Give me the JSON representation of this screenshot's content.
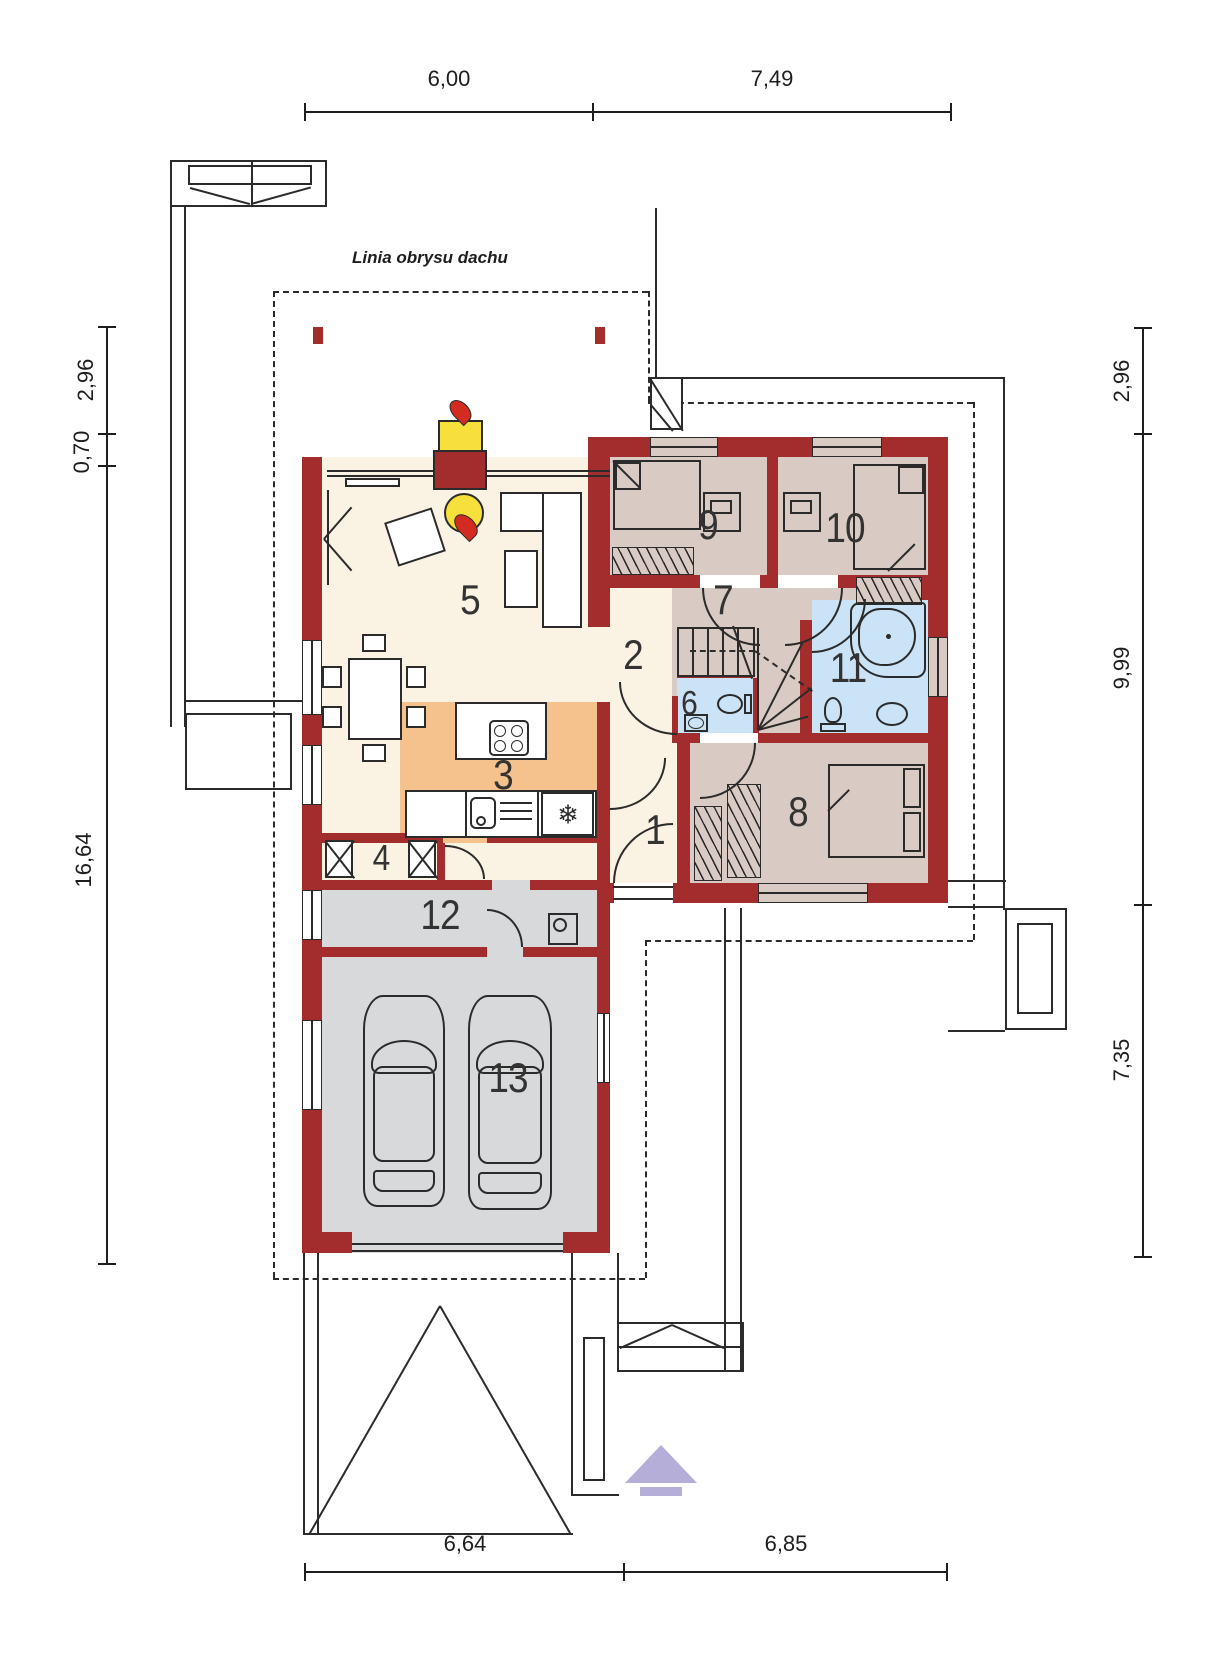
{
  "annotation": "Linia obrysu dachu",
  "rooms": [
    {
      "number": "1"
    },
    {
      "number": "2"
    },
    {
      "number": "3"
    },
    {
      "number": "4"
    },
    {
      "number": "5"
    },
    {
      "number": "6"
    },
    {
      "number": "7"
    },
    {
      "number": "8"
    },
    {
      "number": "9"
    },
    {
      "number": "10"
    },
    {
      "number": "11"
    },
    {
      "number": "12"
    },
    {
      "number": "13"
    }
  ],
  "dimensions": {
    "top": [
      "6,00",
      "7,49"
    ],
    "bottom": [
      "6,64",
      "6,85"
    ],
    "left": [
      "2,96",
      "0,70",
      "16,64"
    ],
    "right": [
      "2,96",
      "9,99",
      "7,35"
    ]
  },
  "icons": {
    "fridge_snowflake": "❄"
  },
  "colors": {
    "wall": "#A32C2C",
    "living_cream": "#FAF3E3",
    "bedroom_tan": "#D9CBC3",
    "bath_blue": "#CBE3F6",
    "kitchen_orange": "#F5C18D",
    "garage_gray": "#D8D9DA",
    "window_tan": "#D9CBC3",
    "fire_yellow": "#F7E03C",
    "flame_red": "#D42B20",
    "accent_purple": "#B4AED9"
  }
}
